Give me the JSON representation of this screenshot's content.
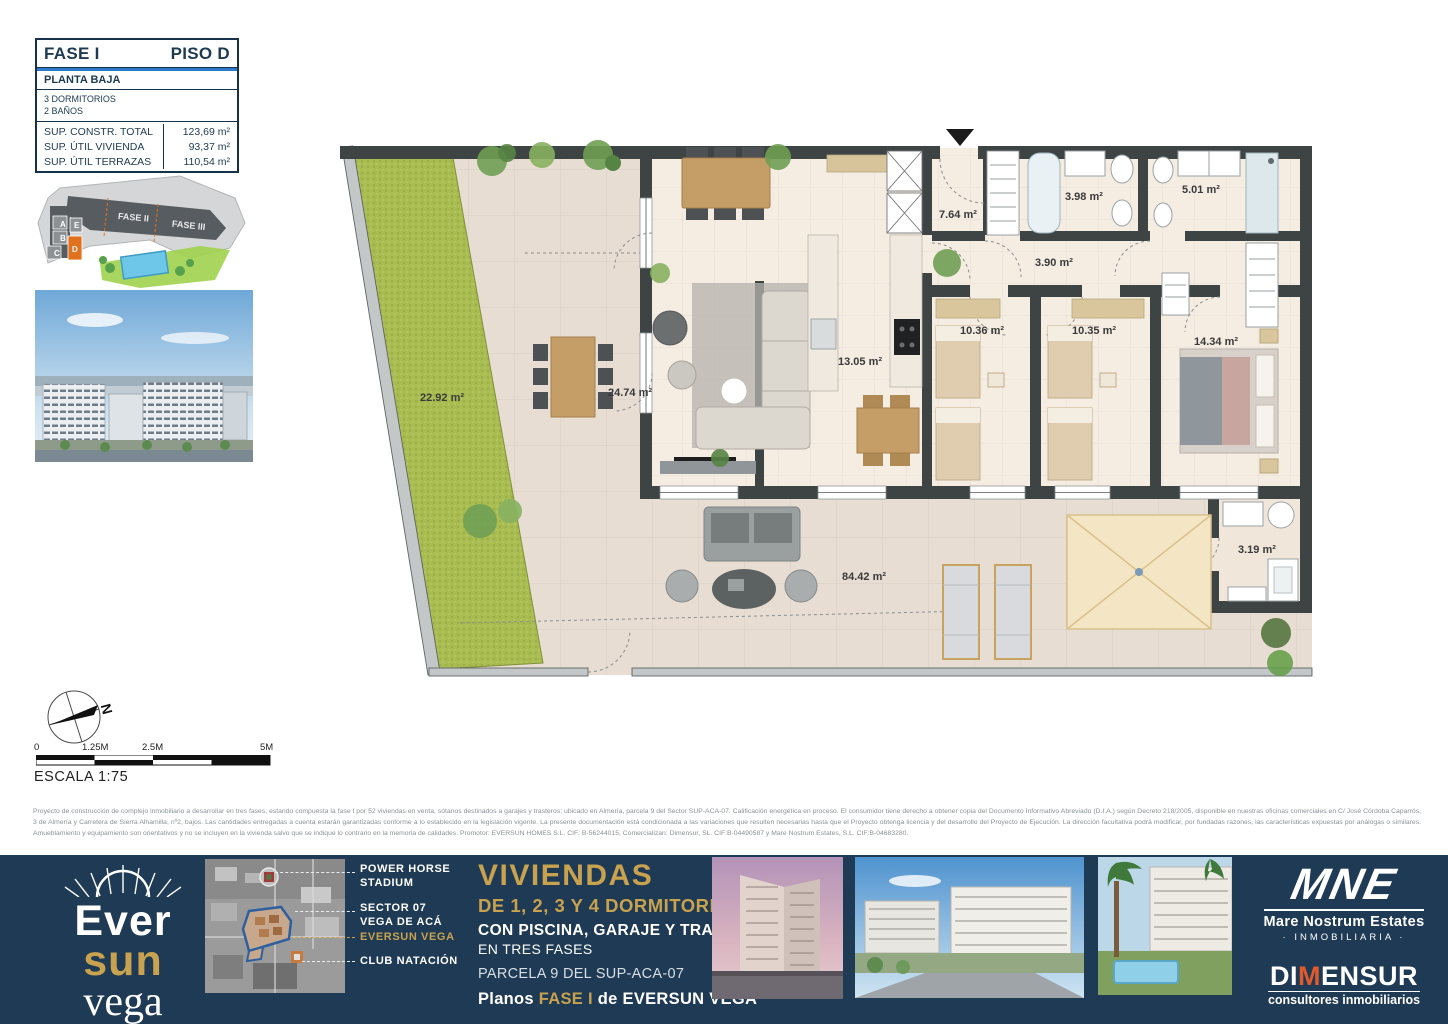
{
  "info_box": {
    "fase": "FASE I",
    "piso": "PISO D",
    "planta": "PLANTA BAJA",
    "dormitorios": "3 DORMITORIOS",
    "banos": "2 BAÑOS",
    "rows": [
      {
        "label": "SUP. CONSTR. TOTAL",
        "value": "123,69 m²"
      },
      {
        "label": "SUP. ÚTIL VIVIENDA",
        "value": "93,37 m²"
      },
      {
        "label": "SUP. ÚTIL TERRAZAS",
        "value": "110,54 m²"
      }
    ]
  },
  "site_plan": {
    "fase2_label": "FASE II",
    "fase3_label": "FASE III",
    "unit_a": "A",
    "unit_b": "B",
    "unit_c": "C",
    "unit_d": "D",
    "unit_e": "E",
    "highlight_color": "#e2711d"
  },
  "floor_plan": {
    "rooms": {
      "living": "24.74 m²",
      "hall": "7.64 m²",
      "bath_1": "3.98 m²",
      "bath_2": "5.01 m²",
      "corridor": "3.90 m²",
      "bedroom_1": "10.36 m²",
      "bedroom_2": "10.35 m²",
      "bedroom_master": "14.34 m²",
      "kitchen": "13.05 m²",
      "garden": "22.92 m²",
      "terrace": "84.42 m²",
      "laundry": "3.19 m²"
    }
  },
  "compass": {
    "north_label": "N"
  },
  "scale_bar": {
    "tick_0": "0",
    "tick_1": "1.25M",
    "tick_2": "2.5M",
    "tick_3": "5M",
    "label": "ESCALA 1:75"
  },
  "disclaimer": "Proyecto de construcción de complejo inmobiliario a desarrollar en tres fases, estando compuesta la fase I por 52 viviendas en venta, sótanos destinados a garajes y trasteros; ubicado en Almería, parcela 9 del Sector SUP-ACA-07. Calificación energética en proceso. El consumidor tiene derecho a obtener copia del Documento Informativo Abreviado (D.I.A.) según Decreto 218/2005, disponible en nuestras oficinas comerciales en C/ José Córdoba Caparrós, 3 de Almería y Carretera de Sierra Alhamilla, nº2, bajos. Las cantidades entregadas a cuenta estarán garantizadas conforme a lo establecido en la legislación vigente. La presente documentación está condicionada a las variaciones que resulten necesarias hasta que el Proyecto obtenga licencia y del desarrollo del Proyecto de Ejecución. La dirección facultativa podrá modificar, por fundadas razones, las características expuestas por análogas o similares. Amueblamiento y equipamiento son orientativos y no se incluyen en la vivienda salvo que se indique lo contrario en la memoria de calidades. Promotor: EVERSUN HOMES S.L. CIF: B-56244015, Comercializan: Dimensur, SL. CIF:B-04490587 y Mare Nostrum Estates, S.L. CIF:B-04683280.",
  "footer": {
    "brand": {
      "line1": "Ever",
      "line2": "sun",
      "line3": "vega"
    },
    "map_labels": {
      "stadium_1": "POWER HORSE",
      "stadium_2": "STADIUM",
      "sector_1": "SECTOR 07",
      "sector_2": "VEGA DE ACÁ",
      "eversun": "EVERSUN VEGA",
      "club": "CLUB NATACIÓN"
    },
    "headline": "VIVIENDAS",
    "sub_bedrooms": "DE 1, 2, 3 Y 4 DORMITORIOS,",
    "sub_amenities": "CON PISCINA, GARAJE Y TRASTEROS,",
    "sub_phases": "EN TRES FASES",
    "parcela": "PARCELA 9 DEL SUP-ACA-07",
    "planos_prefix": "Planos",
    "planos_fase": "FASE I",
    "planos_mid": "de",
    "planos_brand": "EVERSUN VEGA",
    "mne": {
      "acronym": "MNE",
      "name": "Mare Nostrum Estates",
      "tagline": "· INMOBILIARIA ·"
    },
    "dimensur": {
      "name_di": "DI",
      "name_m": "M",
      "name_ensur": "ENSUR",
      "tagline": "consultores inmobiliarios"
    }
  },
  "colors": {
    "navy": "#1e3a54",
    "gold": "#c8a24e",
    "orange": "#e2711d",
    "garden_green": "#a9bc51"
  }
}
